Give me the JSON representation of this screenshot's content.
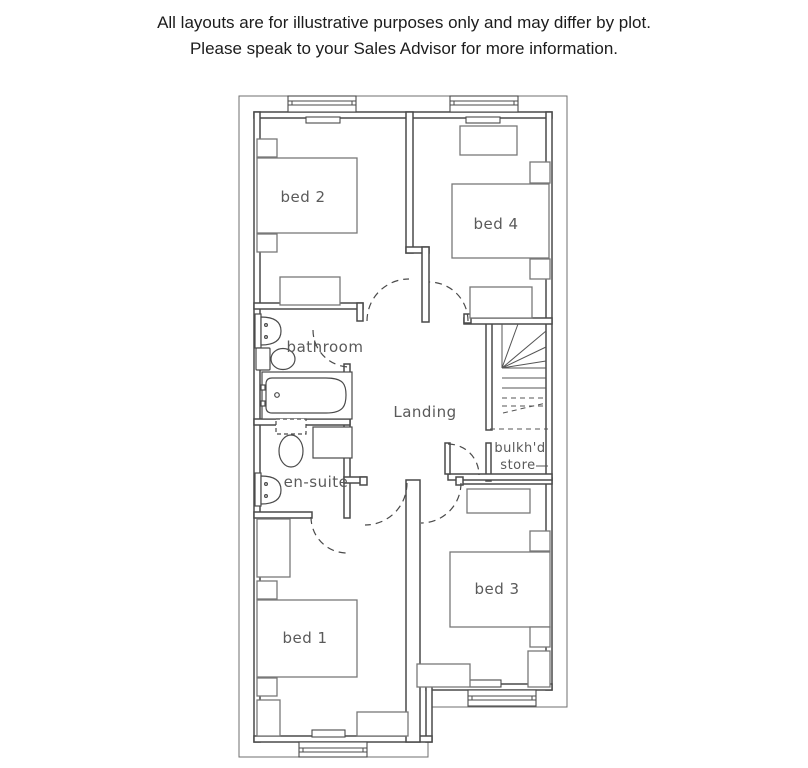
{
  "disclaimer": {
    "line1": "All layouts are for illustrative purposes only and may differ by plot.",
    "line2": "Please speak to your Sales Advisor for more information."
  },
  "plan": {
    "labels": {
      "bed2": "bed 2",
      "bed4": "bed 4",
      "bathroom": "bathroom",
      "landing": "Landing",
      "ensuite": "en-suite",
      "store_line1": "bulkh'd",
      "store_line2": "store",
      "bed1": "bed 1",
      "bed3": "bed 3"
    },
    "colors": {
      "wall": "#4a4a4a",
      "furniture": "#787878",
      "label_text": "#5a5a5a",
      "disclaimer_text": "#1c1c1c",
      "background": "#ffffff"
    }
  }
}
